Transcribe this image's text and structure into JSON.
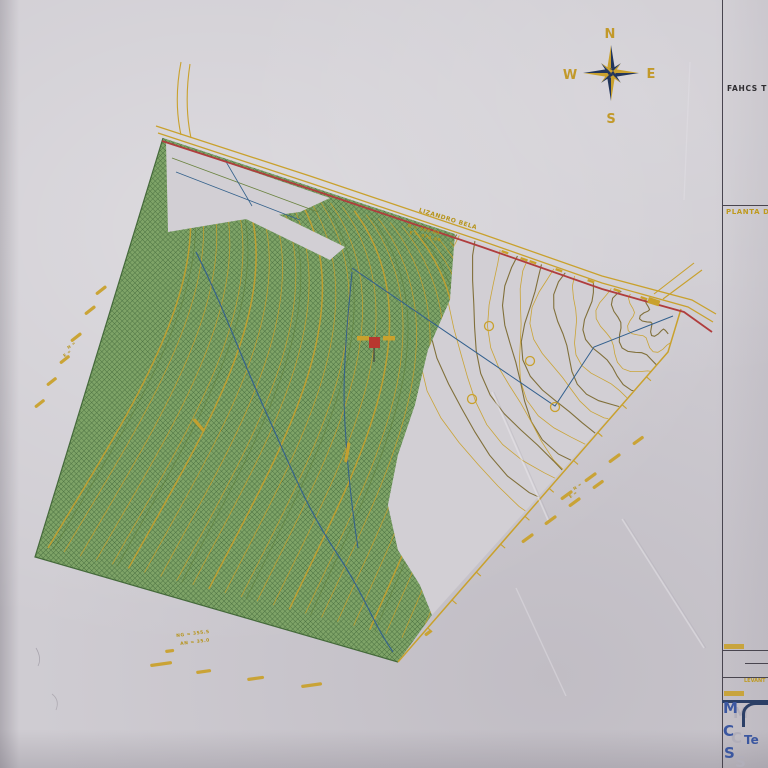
{
  "page": {
    "type": "photographed topographic survey plan"
  },
  "compass": {
    "north": "N",
    "south": "S",
    "east": "E",
    "west": "W"
  },
  "title_block": {
    "heading": "FAHCS T",
    "plan_label": "PLANTA D",
    "survey_label": "LEVANT",
    "logo_letters": [
      "M",
      "C",
      "S"
    ],
    "company_text": "Te"
  },
  "map_labels": [
    {
      "text": "LIZANDRO  BELA",
      "x": 420,
      "y": 207,
      "rot": 17,
      "size": 6,
      "color": "#b6941c"
    },
    {
      "text": "N = 355.00",
      "x": 408,
      "y": 224,
      "rot": 14,
      "size": 4.5,
      "color": "#b6941c"
    },
    {
      "text": "E = 973.00",
      "x": 410,
      "y": 231,
      "rot": 14,
      "size": 4.5,
      "color": "#b6941c"
    },
    {
      "text": "NG = 355.5",
      "x": 176,
      "y": 634,
      "rot": -7,
      "size": 4.5,
      "color": "#b6941c"
    },
    {
      "text": "AN = 35.0",
      "x": 180,
      "y": 642,
      "rot": -7,
      "size": 4.5,
      "color": "#b6941c"
    },
    {
      "text": "N =",
      "x": 66,
      "y": 346,
      "rot": -38,
      "size": 4,
      "color": "#b6941c"
    },
    {
      "text": "E =",
      "x": 62,
      "y": 354,
      "rot": -38,
      "size": 4,
      "color": "#b6941c"
    },
    {
      "text": "N =",
      "x": 572,
      "y": 487,
      "rot": -36,
      "size": 4,
      "color": "#b6941c"
    },
    {
      "text": "E =",
      "x": 568,
      "y": 495,
      "rot": -36,
      "size": 4,
      "color": "#b6941c"
    }
  ],
  "colors": {
    "paper": "#d2cfd4",
    "contour_yellow": "#c9a12d",
    "contour_olive": "#7c6a33",
    "vegetation_green": "#7ea367",
    "hatch_green": "#4a7040",
    "boundary_red": "#b03d3d",
    "water_blue": "#35628c",
    "logo_blue": "#3b57a0",
    "ink_black": "#2e2c30"
  }
}
